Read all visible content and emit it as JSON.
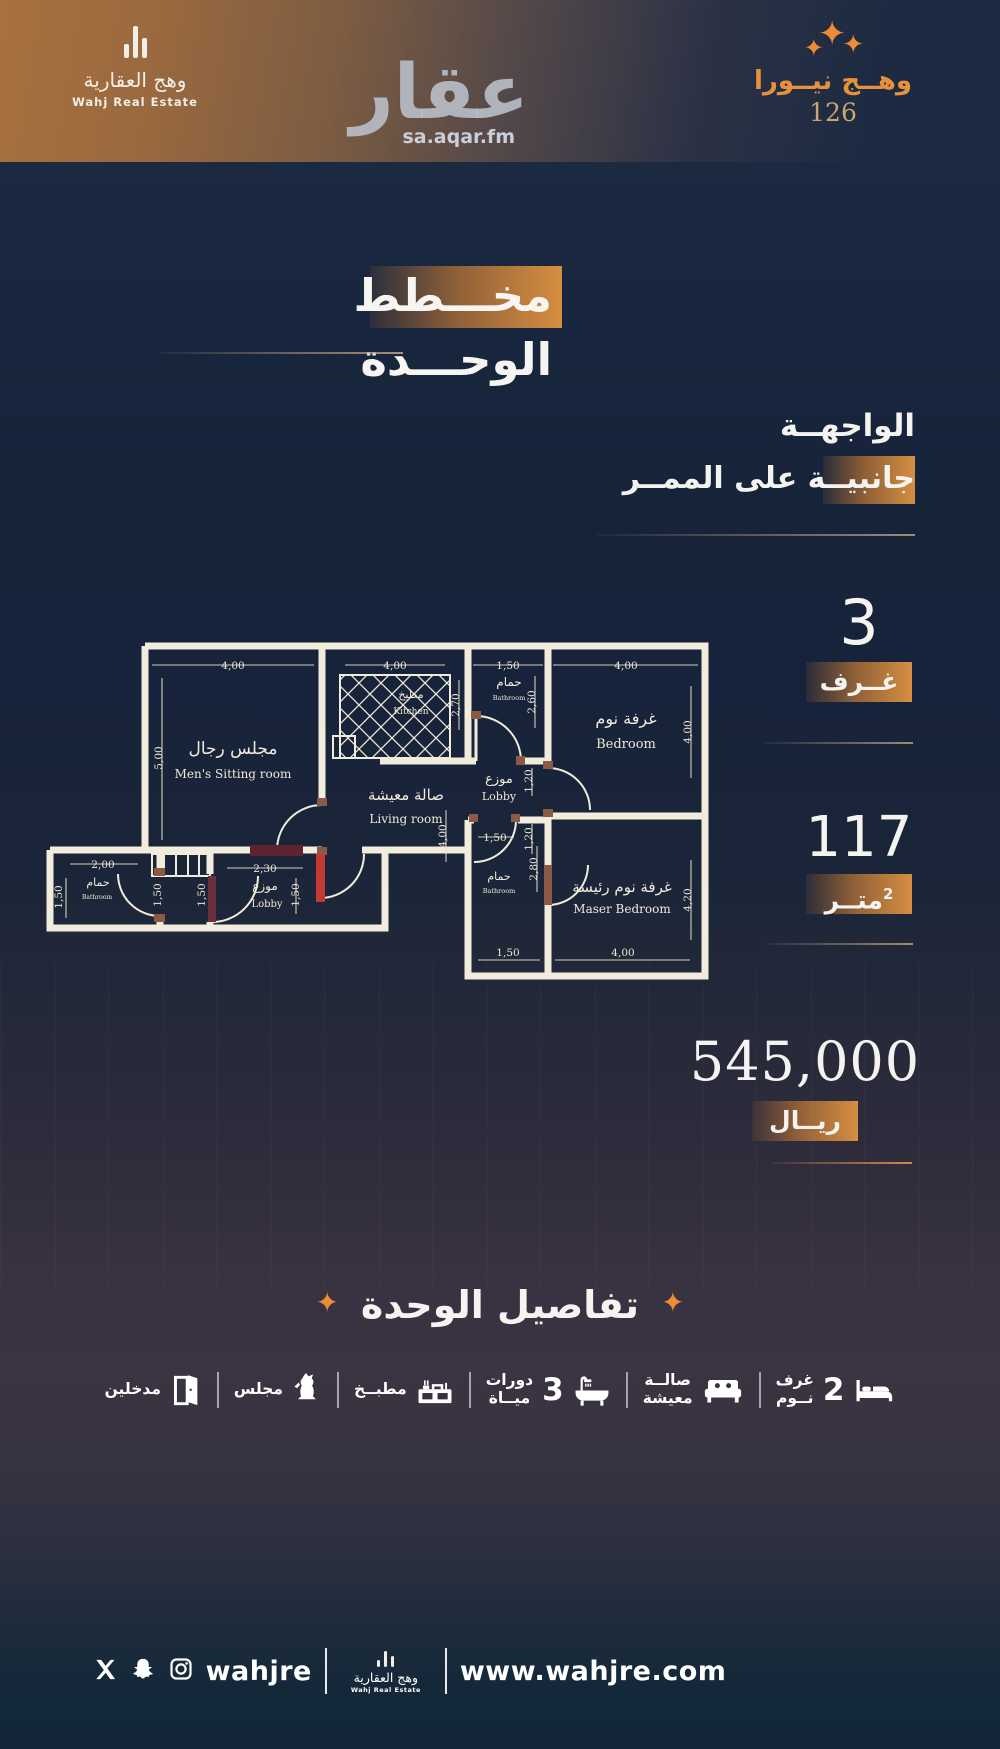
{
  "colors": {
    "accent": "#D98E3F",
    "bg_navy": "#17253C",
    "bg_plum": "#393241",
    "wall_cream": "#F2ECDC",
    "red_door": "#C23B33",
    "star_orange": "#ED8C33"
  },
  "header": {
    "brand": {
      "name_ar": "وهج العقارية",
      "name_en": "Wahj Real Estate"
    },
    "watermark": {
      "logo": "عقار",
      "site": "sa.aqar.fm"
    },
    "project": {
      "star": "✦",
      "name": "وهــج نيــورا",
      "number": "126"
    }
  },
  "title": {
    "text": "مخـــطط الوحـــدة"
  },
  "facade": {
    "label": "الواجهــة",
    "value": "جانبيــة على الممــر"
  },
  "stats": {
    "rooms": {
      "value": "3",
      "unit": "غــرف"
    },
    "area": {
      "value": "117",
      "unit": "متــر",
      "sup": "2"
    },
    "price": {
      "value": "545,000",
      "unit": "ريــال"
    }
  },
  "plan": {
    "rooms": {
      "sitting": {
        "ar": "مجلس رجال",
        "en": "Men's Sitting room"
      },
      "kitchen": {
        "ar": "مطبخ",
        "en": "Kitchen"
      },
      "bath_top": {
        "ar": "حمام",
        "en": "Bathroom"
      },
      "bedroom": {
        "ar": "غرفة نوم",
        "en": "Bedroom"
      },
      "living": {
        "ar": "صالة معيشة",
        "en": "Living room"
      },
      "lobby": {
        "ar": "موزع",
        "en": "Lobby"
      },
      "master": {
        "ar": "غرفة نوم رئيسة",
        "en": "Maser Bedroom"
      },
      "bath_bottom": {
        "ar": "حمام",
        "en": "Bathroom"
      },
      "bath_annex": {
        "ar": "حمام",
        "en": "Bathroom"
      },
      "lobby_annex": {
        "ar": "موزع",
        "en": "Lobby"
      }
    },
    "dims": {
      "sitting_w": "4,00",
      "sitting_h": "5,00",
      "kitchen_w": "4,00",
      "bath_top_w": "1,50",
      "bath_top_left_h": "2,70",
      "bath_top_right_h": "2,60",
      "bedroom_w": "4,00",
      "bedroom_h": "4,00",
      "lobby_h_upper": "1,20",
      "lobby_h_lower": "1,20",
      "living_h": "4,00",
      "annex_bath_w": "2,00",
      "annex_bath_h": "1,50",
      "stairs_left_h": "1,50",
      "stairs_right_h": "1,50",
      "annex_lobby_w": "2,30",
      "annex_lobby_h": "1,50",
      "bath_bottom_w": "1,50",
      "bath_bottom_h": "2,80",
      "bottom_w_small": "1,50",
      "master_w": "4,00",
      "master_h": "4,20"
    }
  },
  "details": {
    "heading": "تفاصيل الوحدة",
    "diamond": "✦",
    "items": [
      {
        "icon": "bed-icon",
        "count": "2",
        "label1": "غرف",
        "label2": "نــوم"
      },
      {
        "icon": "sofa-icon",
        "label1": "صالــة",
        "label2": "معيشة"
      },
      {
        "icon": "bathtub-icon",
        "count": "3",
        "label1": "دورات",
        "label2": "ميــاة"
      },
      {
        "icon": "kitchen-icon",
        "label1": "مطبــخ"
      },
      {
        "icon": "dallah-icon",
        "label1": "مجلس"
      },
      {
        "icon": "door-icon",
        "label1": "مدخلين"
      }
    ]
  },
  "footer": {
    "handle": "wahjre",
    "brand_ar": "وهج العقارية",
    "brand_en": "Wahj Real Estate",
    "website": "www.wahjre.com"
  }
}
